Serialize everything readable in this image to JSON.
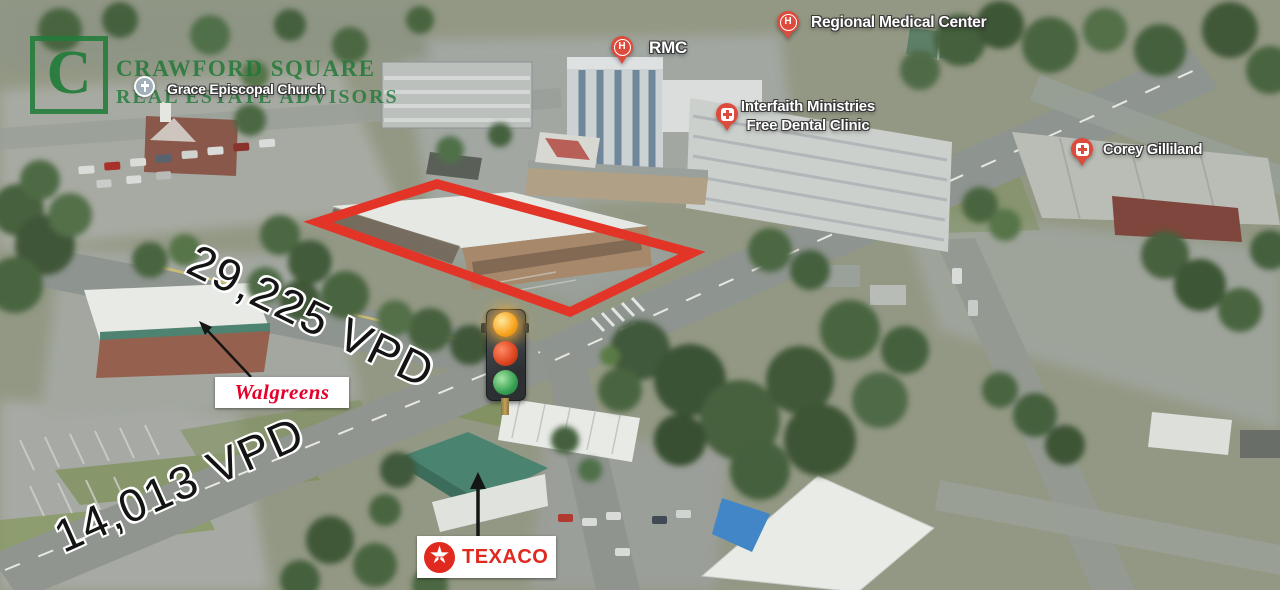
{
  "colors": {
    "brand-green": "#227c3a",
    "pin-red": "#dc4b3c",
    "outline-red": "#e23528",
    "walgreens-red": "#e4002b",
    "texaco-red": "#e0291f",
    "vpd-black": "#141414"
  },
  "branding": {
    "logo_letter": "C",
    "line1": "CRAWFORD SQUARE",
    "line2": "REAL ESTATE ADVISORS"
  },
  "pins": {
    "church": {
      "label": "Grace Episcopal Church"
    },
    "rmc": {
      "label": "RMC",
      "glyph": "H"
    },
    "regional": {
      "label": "Regional Medical Center",
      "glyph": "H"
    },
    "interfaith": {
      "line1": "Interfaith Ministries",
      "line2": "Free Dental Clinic"
    },
    "corey": {
      "label": "Corey Gilliland"
    }
  },
  "traffic_counts": {
    "main_road": "29,225 VPD",
    "cross_road": "14,013 VPD"
  },
  "badges": {
    "walgreens": "Walgreens",
    "texaco": "TEXACO",
    "texaco_star": "★",
    "texaco_letter": "T"
  }
}
